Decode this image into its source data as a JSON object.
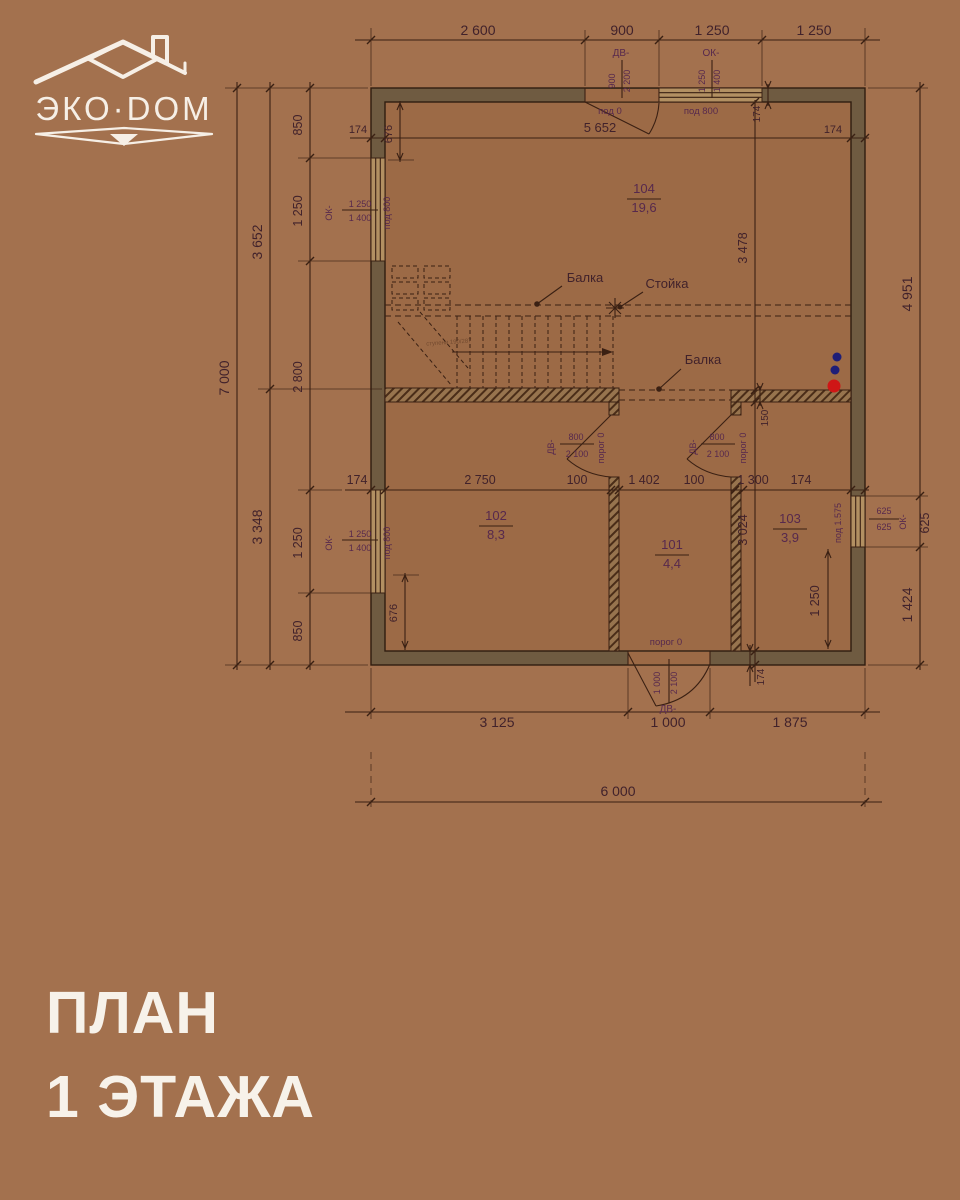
{
  "logo": {
    "brand": "ЭКО·DOM"
  },
  "title": {
    "line1": "ПЛАН",
    "line2": "1 ЭТАЖА"
  },
  "plan": {
    "rooms": [
      {
        "number": "104",
        "area": "19,6"
      },
      {
        "number": "102",
        "area": "8,3"
      },
      {
        "number": "101",
        "area": "4,4"
      },
      {
        "number": "103",
        "area": "3,9"
      }
    ],
    "callouts": {
      "beam_top": "Балка",
      "post": "Стойка",
      "beam_bottom": "Балка",
      "stair_note": "ступени 190/287"
    },
    "openings": {
      "top_door": {
        "code": "ДВ-",
        "width": "900",
        "height": "2 200",
        "sill": "под 0"
      },
      "top_window": {
        "code": "ОК-",
        "width": "1 250",
        "height": "1 400",
        "sill": "под 800"
      },
      "left_window_upper": {
        "code": "ОК-",
        "width": "1 250",
        "height": "1 400",
        "sill": "под 800"
      },
      "left_window_lower": {
        "code": "ОК-",
        "width": "1 250",
        "height": "1 400",
        "sill": "под 800"
      },
      "right_window": {
        "code": "ОК-",
        "width": "625",
        "height": "625",
        "sill": "под 1.575"
      },
      "door_room102": {
        "code": "ДВ-",
        "width": "800",
        "height": "2 100",
        "sill": "порог 0"
      },
      "door_room101": {
        "code": "ДВ-",
        "width": "800",
        "height": "2 100",
        "sill": "порог 0"
      },
      "entry_door": {
        "code": "ДВ-",
        "width": "1 000",
        "height": "2 100",
        "sill": "порог 0"
      }
    },
    "dims": {
      "top": {
        "s1": "2 600",
        "s2": "900",
        "s3": "1 250",
        "s4": "1 250"
      },
      "left": {
        "total": "7 000",
        "upper": "3 652",
        "lower": "3 348",
        "c1": "850",
        "c2": "1 250",
        "c3": "2 800",
        "c4": "1 250",
        "c5": "850"
      },
      "right": {
        "total": "4 951",
        "window": "625",
        "below_window": "1 424",
        "inner_upper": "3 478",
        "inner_lower": "3 024",
        "wall": "150",
        "sill_to_floor": "1 250"
      },
      "middle": {
        "s1": "174",
        "s2": "2 750",
        "s3": "100",
        "s4": "1 402",
        "s5": "100",
        "s6": "1 300",
        "s7": "174"
      },
      "bottom": {
        "s1": "3 125",
        "s2": "1 000",
        "s3": "1 875",
        "total": "6 000",
        "wall": "174"
      },
      "inner_top": {
        "width": "5 652",
        "wall_left": "174",
        "wall_right": "174",
        "corner": "174",
        "offset": "676"
      },
      "inner_bottom": {
        "offset": "676"
      }
    }
  }
}
